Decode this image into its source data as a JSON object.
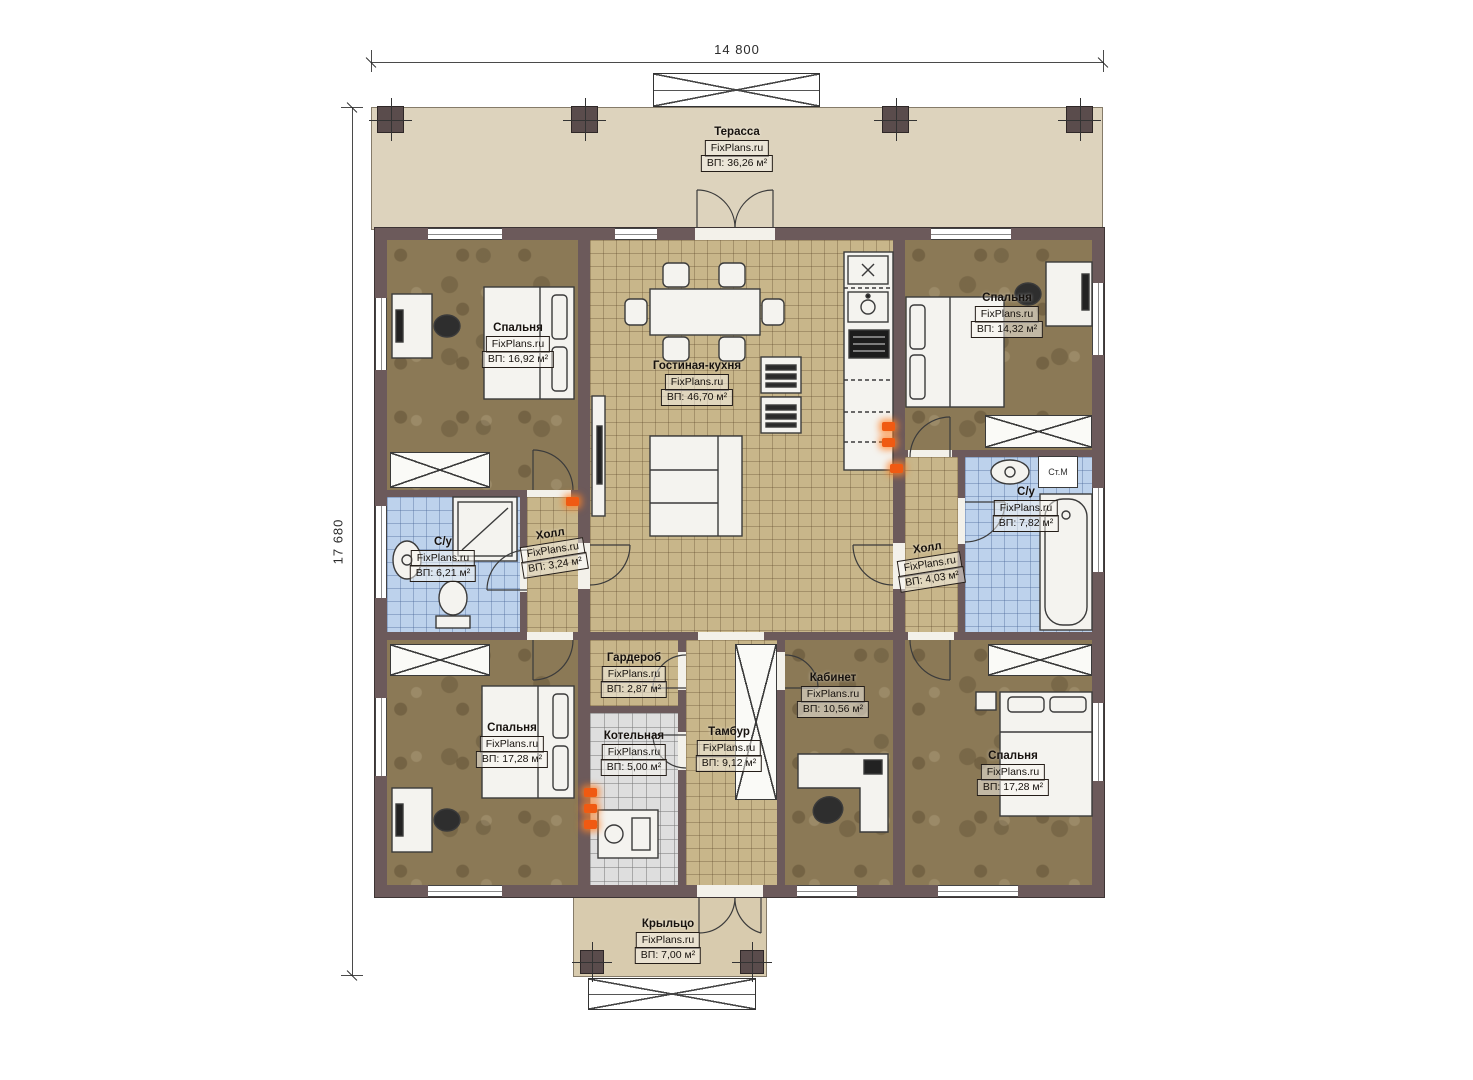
{
  "plan": {
    "brand": "FixPlans.ru",
    "dimensions": {
      "width": "14 800",
      "height": "17 680"
    },
    "washer_label": "Ст.М",
    "rooms": {
      "terrace": {
        "name": "Терасса",
        "area": "ВП: 36,26 м²"
      },
      "bedroom_tl": {
        "name": "Спальня",
        "area": "ВП: 16,92 м²"
      },
      "living": {
        "name": "Гостиная-кухня",
        "area": "ВП: 46,70 м²"
      },
      "bedroom_tr": {
        "name": "Спальня",
        "area": "ВП: 14,32 м²"
      },
      "bath_l": {
        "name": "С/у",
        "area": "ВП: 6,21 м²"
      },
      "hall_l": {
        "name": "Холл",
        "area": "ВП: 3,24 м²"
      },
      "hall_r": {
        "name": "Холл",
        "area": "ВП: 4,03 м²"
      },
      "bath_r": {
        "name": "С/у",
        "area": "ВП: 7,82 м²"
      },
      "bedroom_bl": {
        "name": "Спальня",
        "area": "ВП: 17,28 м²"
      },
      "wardrobe": {
        "name": "Гардероб",
        "area": "ВП: 2,87 м²"
      },
      "boiler": {
        "name": "Котельная",
        "area": "ВП: 5,00 м²"
      },
      "tambour": {
        "name": "Тамбур",
        "area": "ВП: 9,12 м²"
      },
      "office": {
        "name": "Кабинет",
        "area": "ВП: 10,56 м²"
      },
      "bedroom_br": {
        "name": "Спальня",
        "area": "ВП: 17,28 м²"
      },
      "porch": {
        "name": "Крыльцо",
        "area": "ВП: 7,00 м²"
      }
    },
    "colors": {
      "wall": "#6c5a5b",
      "terrace_fill": "#ddd3bd",
      "floor_wood": "#8b7956",
      "floor_tile_tan": "#c8b68a",
      "floor_tile_blue": "#bdd2ec",
      "floor_tile_gray": "#dedede",
      "marker": "#f05a12"
    }
  }
}
